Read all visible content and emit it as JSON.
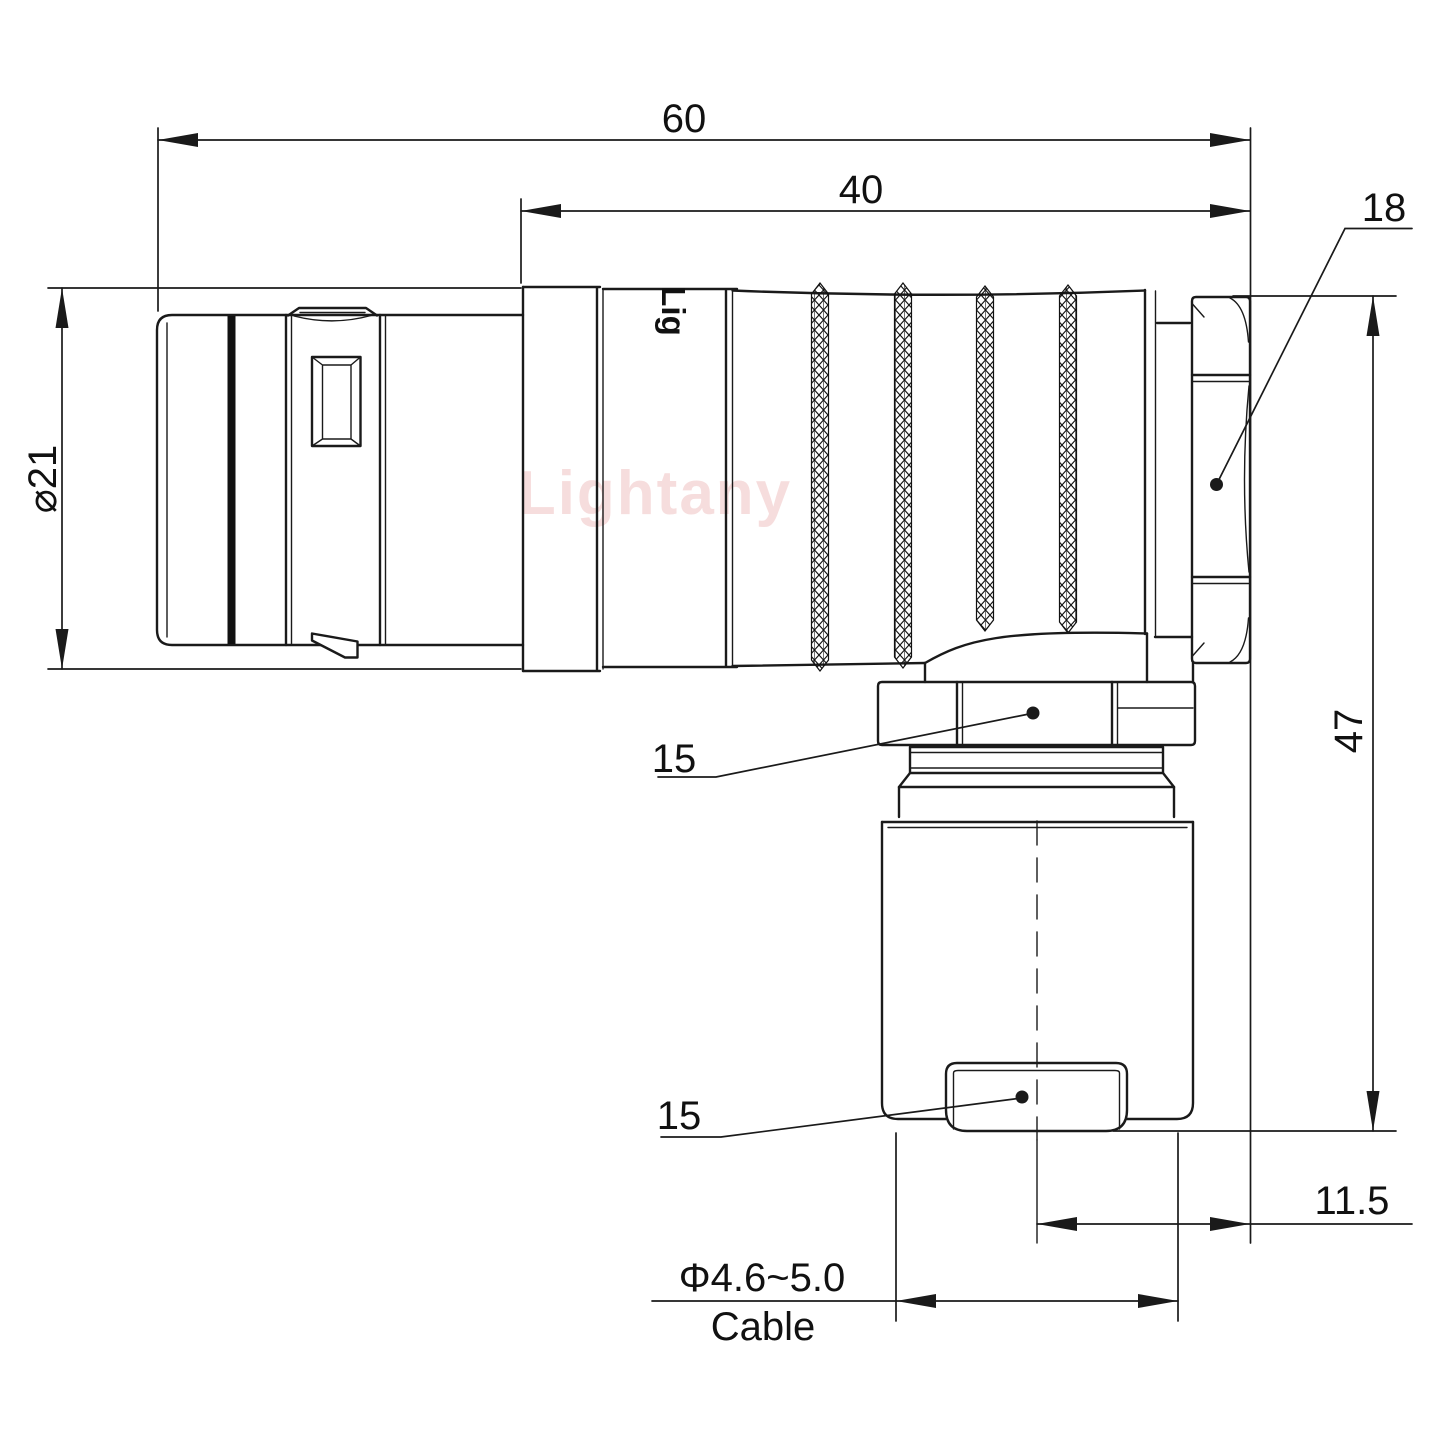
{
  "canvas": {
    "width": 1440,
    "height": 1440,
    "background": "#ffffff",
    "line_color": "#1a1a1a",
    "watermark_color": "#f2c9c9"
  },
  "watermark": {
    "text": "Lightany"
  },
  "part": {
    "engraving": "Lig"
  },
  "dimensions": {
    "overall_length": {
      "value": "60"
    },
    "body_length": {
      "value": "40"
    },
    "back_nut": {
      "value": "18"
    },
    "outer_diameter": {
      "value": "⌀21"
    },
    "overall_height": {
      "value": "47"
    },
    "elbow_nut": {
      "value": "15"
    },
    "cable_clamp": {
      "value": "15"
    },
    "bend_offset": {
      "value": "11.5"
    },
    "cable": {
      "diameter": "Φ4.6~5.0",
      "label": "Cable"
    }
  }
}
